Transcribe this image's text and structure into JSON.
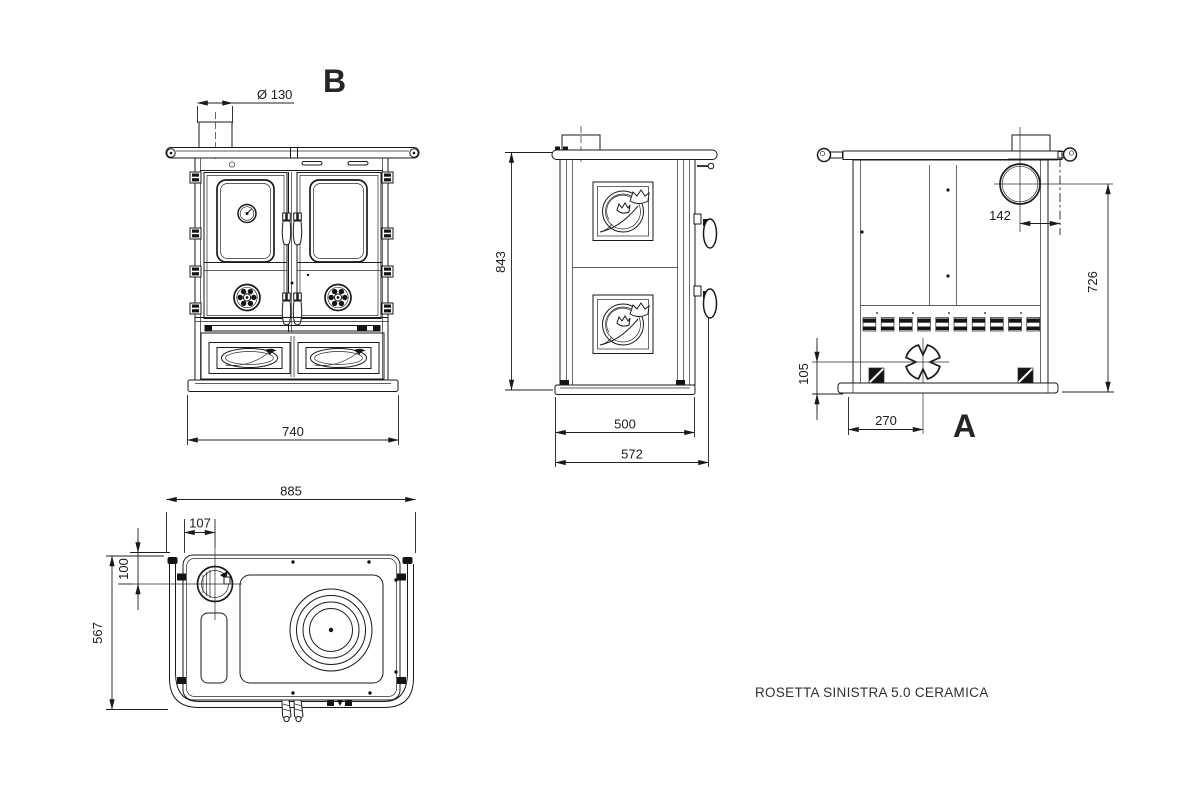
{
  "product": {
    "name": "ROSETTA SINISTRA 5.0 CERAMICA"
  },
  "views": {
    "front": {
      "label": "B",
      "dims": {
        "flue_diameter": "Ø 130",
        "overall_width": "740"
      }
    },
    "side": {
      "dims": {
        "overall_height": "843",
        "body_depth": "500",
        "overall_depth": "572"
      }
    },
    "rear": {
      "label": "A",
      "dims": {
        "flue_to_side": "142",
        "flue_center_height": "726",
        "intake_center_height": "105",
        "intake_from_side": "270"
      }
    },
    "top": {
      "dims": {
        "overall_width": "885",
        "flue_center_x": "107",
        "flue_center_y": "100",
        "overall_depth": "567"
      }
    }
  },
  "colors": {
    "line": "#1a1a1a",
    "background": "#ffffff"
  }
}
